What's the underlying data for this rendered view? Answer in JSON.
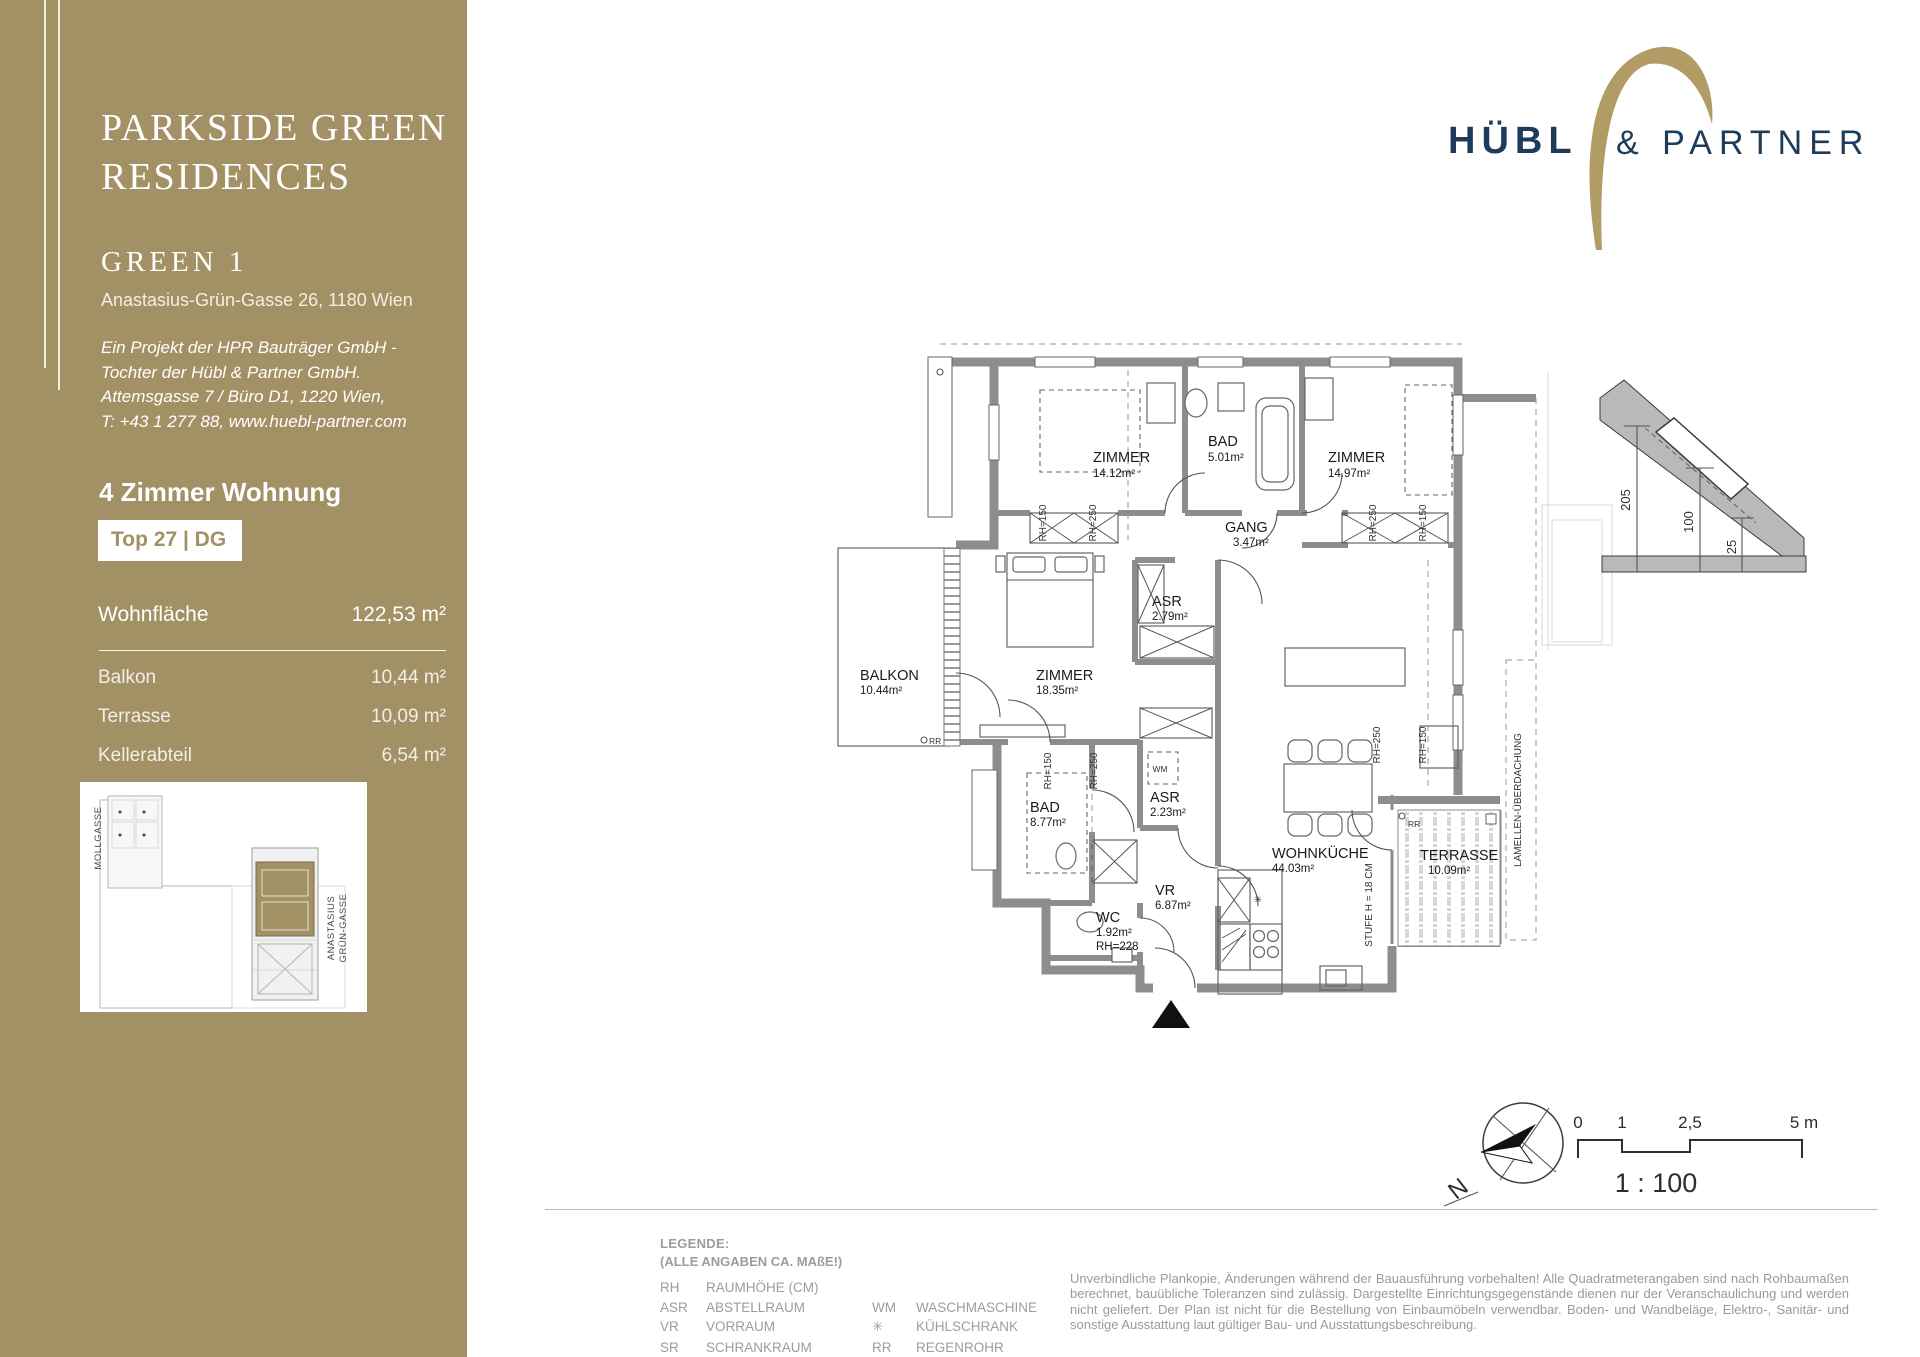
{
  "sidebar": {
    "title_line1": "PARKSIDE GREEN",
    "title_line2": "RESIDENCES",
    "project_name": "GREEN 1",
    "address": "Anastasius-Grün-Gasse 26, 1180 Wien",
    "developer_line1": "Ein Projekt der HPR Bauträger GmbH -",
    "developer_line2": "Tochter der Hübl & Partner GmbH.",
    "developer_line3": "Attemsgasse 7 / Büro D1, 1220 Wien,",
    "developer_line4": "T: +43 1 277 88, www.huebl-partner.com",
    "apartment_type": "4 Zimmer Wohnung",
    "unit_badge": "Top 27 | DG",
    "living_area_label": "Wohnfläche",
    "living_area_value": "122,53 m²",
    "areas": [
      {
        "label": "Balkon",
        "value": "10,44 m²"
      },
      {
        "label": "Terrasse",
        "value": "10,09 m²"
      },
      {
        "label": "Kellerabteil",
        "value": "6,54 m²"
      }
    ],
    "siteplan": {
      "street1": "MOLLGASSE",
      "street2_line1": "ANASTASIUS",
      "street2_line2": "GRÜN-GASSE"
    }
  },
  "logo": {
    "word1": "HÜBL",
    "word2": "& PARTNER"
  },
  "plan": {
    "rooms": [
      {
        "name": "ZIMMER",
        "area": "14.12m²"
      },
      {
        "name": "BAD",
        "area": "5.01m²"
      },
      {
        "name": "ZIMMER",
        "area": "14.97m²"
      },
      {
        "name": "GANG",
        "area": "3.47m²"
      },
      {
        "name": "ASR",
        "area": "2.79m²"
      },
      {
        "name": "ZIMMER",
        "area": "18.35m²"
      },
      {
        "name": "BALKON",
        "area": "10.44m²"
      },
      {
        "name": "BAD",
        "area": "8.77m²"
      },
      {
        "name": "ASR",
        "area": "2.23m²"
      },
      {
        "name": "VR",
        "area": "6.87m²"
      },
      {
        "name": "WC",
        "area": "1.92m²",
        "room_height": "RH=228"
      },
      {
        "name": "WOHNKÜCHE",
        "area": "44.03m²"
      },
      {
        "name": "TERRASSE",
        "area": "10.09m²"
      }
    ],
    "annotations": {
      "rh150": "RH=150",
      "rh250": "RH=250",
      "wm": "WM",
      "rr": "RR",
      "stufe": "STUFE H = 18 CM",
      "lamellen": "LAMELLEN-ÜBERDACHUNG",
      "fridge": "✳"
    }
  },
  "roof_detail": {
    "dims": [
      "205",
      "100",
      "25"
    ]
  },
  "compass": {
    "north": "N"
  },
  "scalebar": {
    "ticks": [
      "0",
      "1",
      "2,5",
      "5 m"
    ],
    "ratio": "1 : 100"
  },
  "legend": {
    "title": "LEGENDE:",
    "subtitle": "(ALLE ANGABEN CA. MAßE!)",
    "col1": [
      [
        "RH",
        "RAUMHÖHE (CM)"
      ],
      [
        "ASR",
        "ABSTELLRAUM"
      ],
      [
        "VR",
        "VORRAUM"
      ],
      [
        "SR",
        "SCHRANKRAUM"
      ]
    ],
    "col2": [
      [
        "WM",
        "WASCHMASCHINE"
      ],
      [
        "✳",
        "KÜHLSCHRANK"
      ],
      [
        "RR",
        "REGENROHR"
      ]
    ]
  },
  "disclaimer": "Unverbindliche Plankopie, Änderungen während der Bauausführung vorbehalten! Alle Quadratmeterangaben sind nach Rohbaumaßen berechnet, bauübliche Toleranzen sind zulässig.  Dargestellte Einrichtungsgegenstände dienen nur der Veranschaulichung und werden nicht geliefert. Der Plan ist nicht für die Bestellung von Einbaumöbeln verwendbar. Boden- und Wandbeläge, Elektro-, Sanitär- und sonstige Ausstattung laut gültiger Bau- und Ausstattungsbeschreibung."
}
